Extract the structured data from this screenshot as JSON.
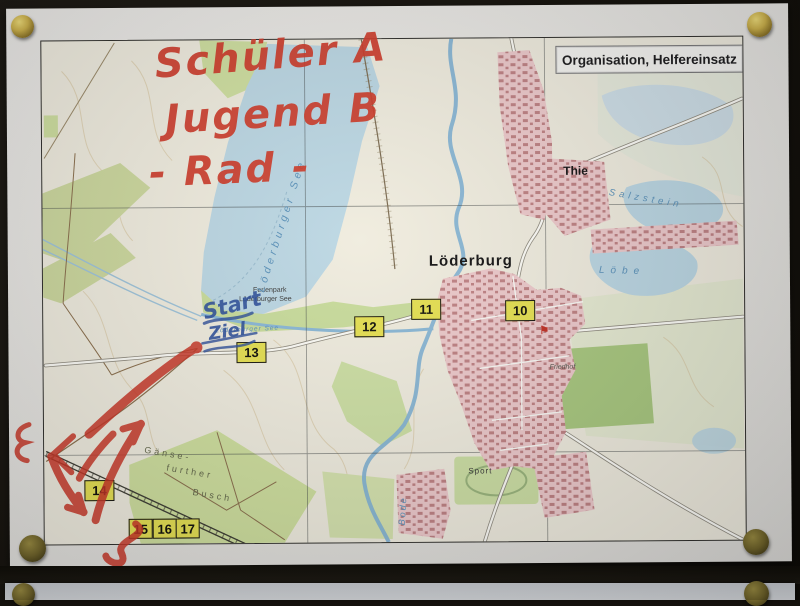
{
  "scene": {
    "description": "Topographic map sheet pinned with brass pins to a dark board; a second sheet is visible below",
    "board_color": "#14110c",
    "paper_color": "#e9e8e5",
    "pin_gold_color": "#cdb24c",
    "pin_olive_color": "#6f632a"
  },
  "map": {
    "org_label": "Organisation, Helfereinsatz",
    "labels": {
      "town": "Löderburg",
      "hamlet": "Thie",
      "ferienpark_line1": "Ferienpark",
      "ferienpark_line2": "Löderburger See",
      "lake": "Löderburger See",
      "channel": "Löderburger See",
      "lake_ne": "Salzstein",
      "lake_e": "Löbe",
      "river": "Bode",
      "forest_1": "Gänse-",
      "forest_2": "further",
      "forest_3": "Busch",
      "sport": "Sport",
      "cemetery": "Friedhof"
    },
    "waypoints": [
      {
        "num": "10"
      },
      {
        "num": "11"
      },
      {
        "num": "12"
      },
      {
        "num": "13"
      },
      {
        "num": "14"
      },
      {
        "num": "15"
      },
      {
        "num": "16"
      },
      {
        "num": "17"
      }
    ],
    "waypoint_box_color": "#e6e154",
    "colors": {
      "water": "#bcd8e6",
      "village_pink": "#edcacd",
      "forest_green": "#cfe0a2",
      "map_cream": "#f0ede1"
    }
  },
  "annotations": {
    "red_marker_color": "#cf3b2b",
    "blue_pen_color": "#2b4e9c",
    "red_text_1": "Schüler A",
    "red_text_2": "Jugend B",
    "red_text_3": "- Rad -",
    "blue_text_1": "Start",
    "blue_text_2": "Ziel"
  }
}
